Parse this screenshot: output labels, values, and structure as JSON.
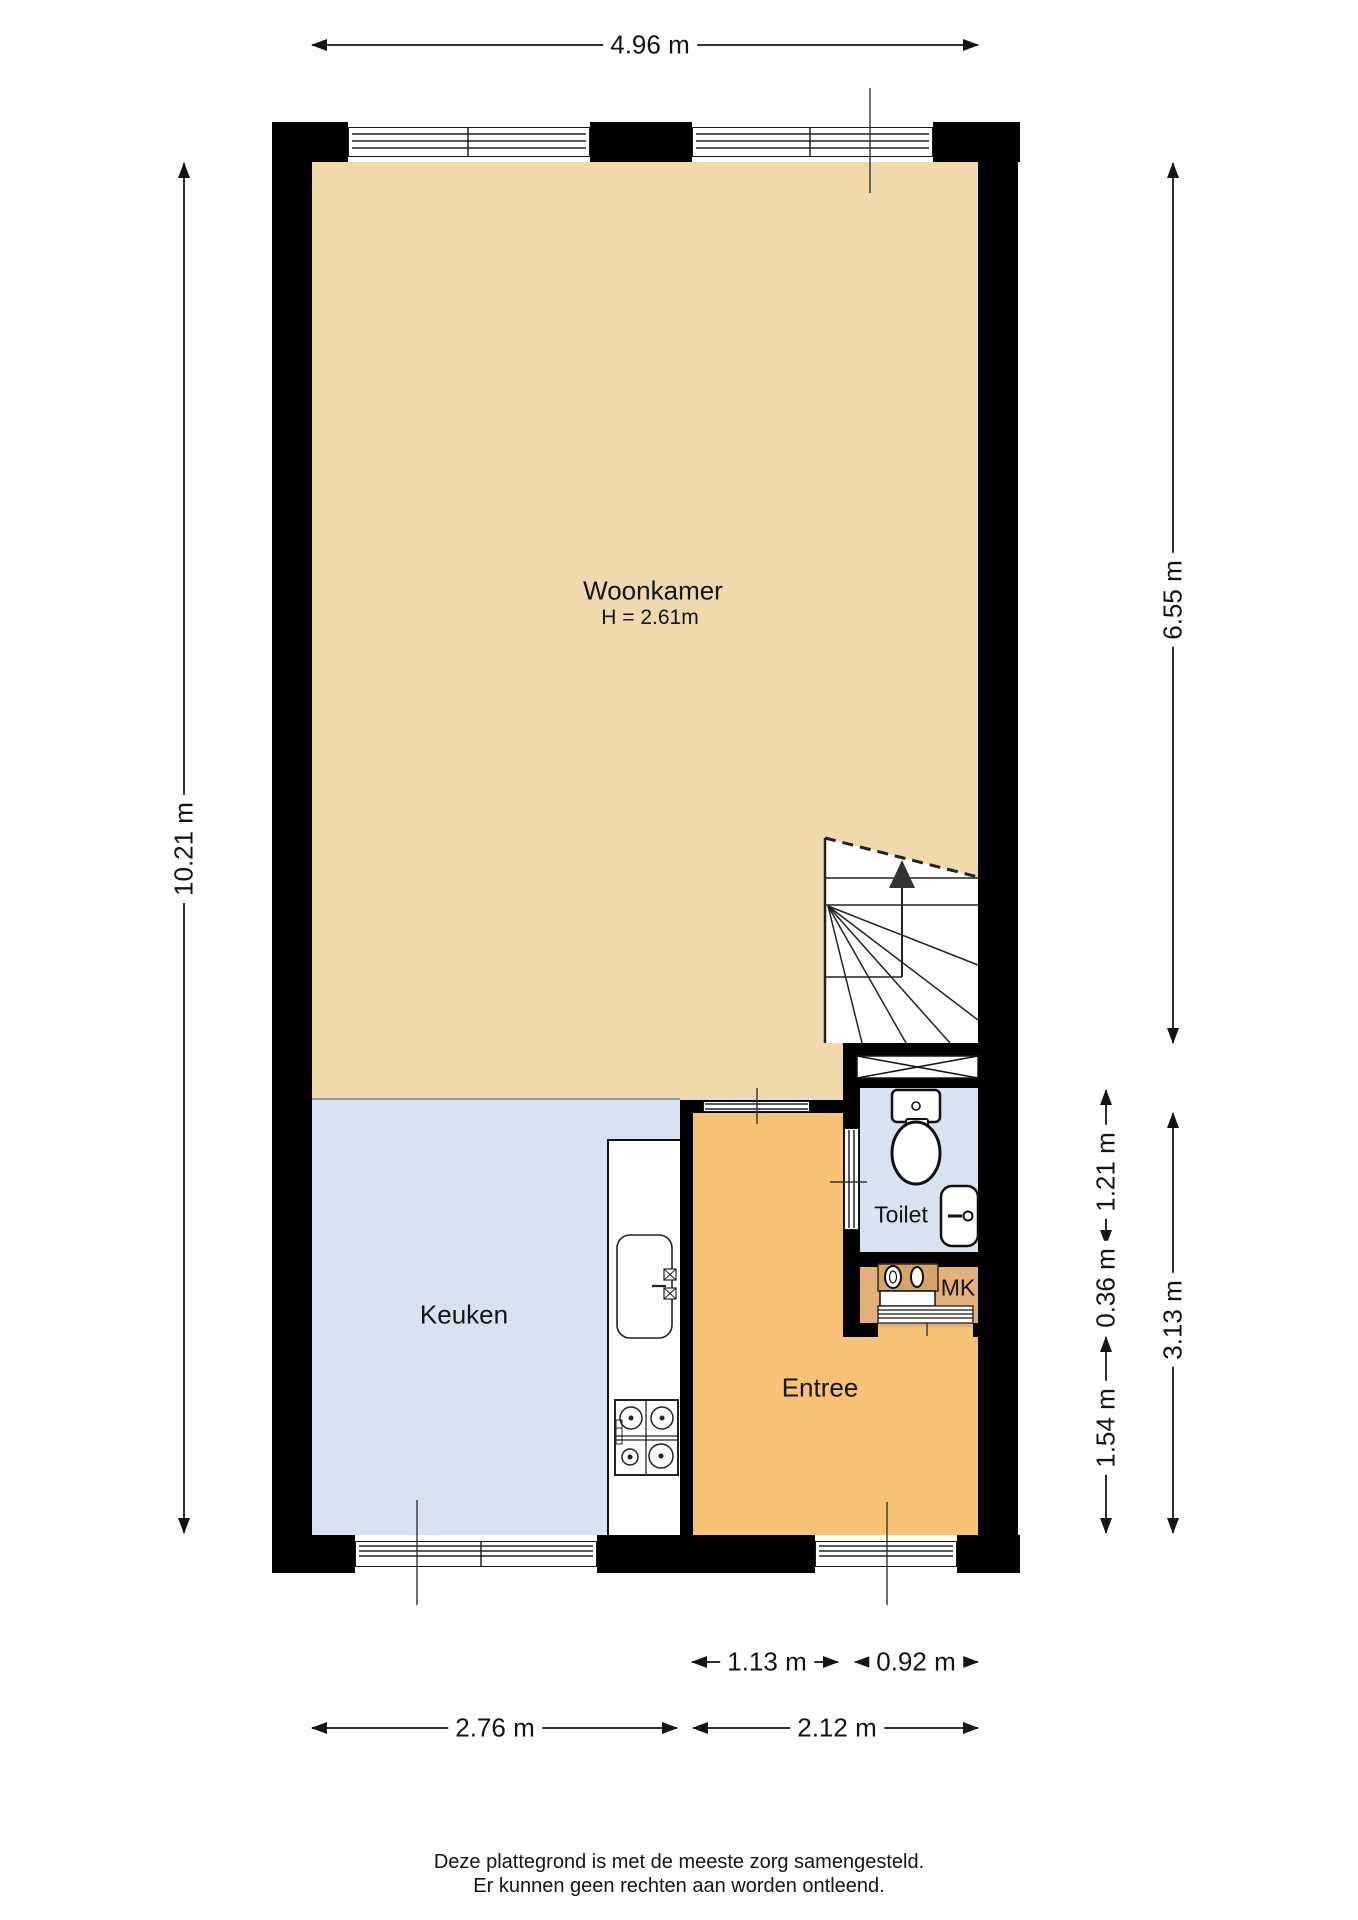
{
  "rooms": {
    "woonkamer": {
      "label": "Woonkamer",
      "height_label": "H = 2.61m"
    },
    "keuken": {
      "label": "Keuken"
    },
    "entree": {
      "label": "Entree"
    },
    "toilet": {
      "label": "Toilet"
    },
    "mk": {
      "label": "MK"
    }
  },
  "dimensions": {
    "top_width": "4.96 m",
    "left_height": "10.21 m",
    "right_upper": "6.55 m",
    "right_lower": "3.13 m",
    "toilet_depth": "1.21 m",
    "mk_depth": "0.36 m",
    "hall_depth": "1.54 m",
    "door_width": "1.13 m",
    "toilet_width": "0.92 m",
    "keuken_width": "2.76 m",
    "entree_width": "2.12 m"
  },
  "footer": {
    "line1": "Deze plattegrond is met de meeste zorg samengesteld.",
    "line2": "Er kunnen geen rechten aan worden ontleend."
  },
  "colors": {
    "wall": "#000000",
    "line": "#1a1a1a",
    "woonkamer": "#f0d9ad",
    "keuken": "#d9e3f0",
    "toilet": "#d9e3f0",
    "entree": "#f6c274",
    "mk": "#e2b07b",
    "mk_shelf": "#d7a265",
    "stairs_arrow": "#333333"
  }
}
